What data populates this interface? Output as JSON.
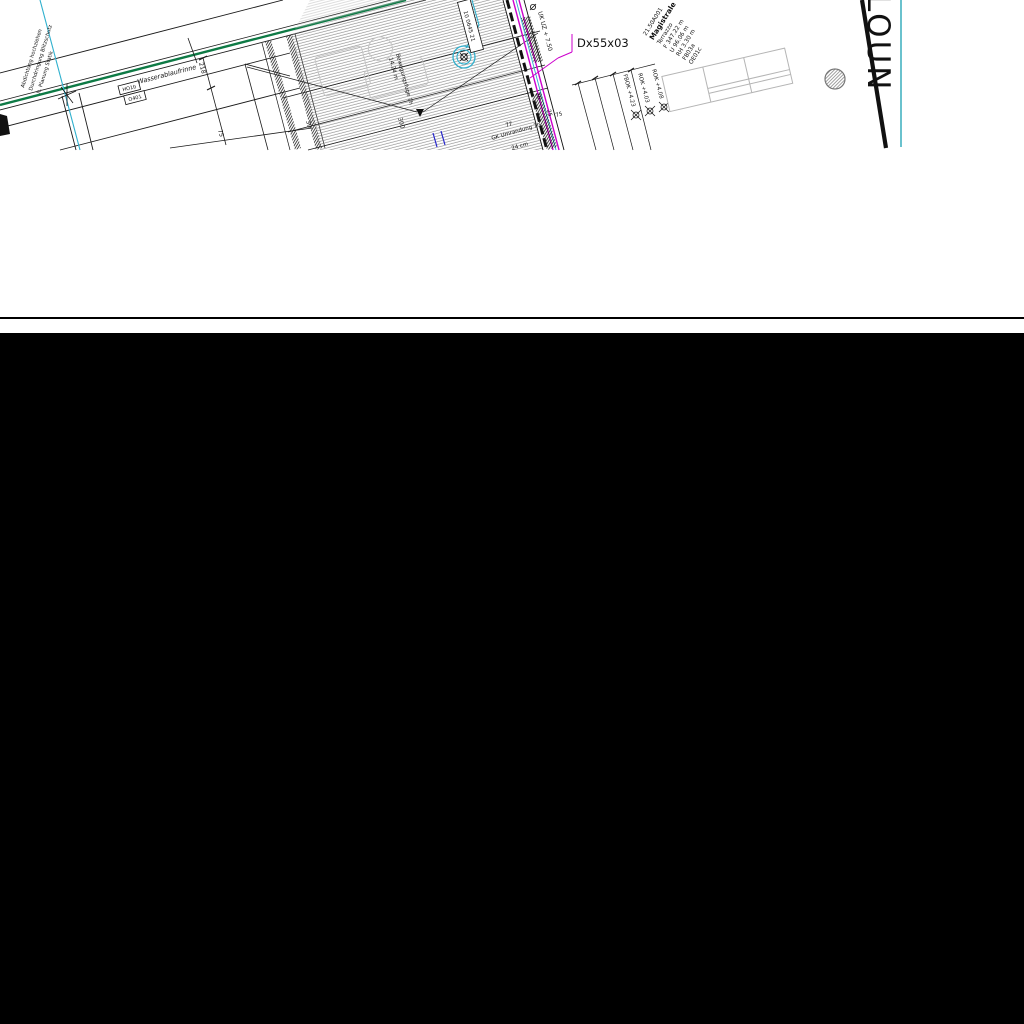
{
  "drawing": {
    "green_note": {
      "lines": [
        "Abdichtung hochziehen",
        "Durchdringung Blitzschutz",
        "lt. Planung Statik"
      ],
      "color": "#00A05A"
    },
    "channel_label": "Wasserablaufrinne",
    "ref_boxes": {
      "top": "HO1b",
      "bottom": "O401"
    },
    "dims": {
      "w218": "218",
      "w75l": "75",
      "w30": "30",
      "w300": "300",
      "w20": "20",
      "w25": "25",
      "w77": "77",
      "w75r": "75"
    },
    "joint_note": {
      "line1": "Bewegungsfuge 7h",
      "line2": "14.24 m"
    },
    "detail_tag": "10 0645 21",
    "uk_level": "UK UZ + 7.50",
    "duct_tag": {
      "text": "Dx55x03",
      "color": "#CC00CC"
    },
    "glass_note": {
      "line1": "GK Umrandung 7h",
      "line2": "24 cm"
    },
    "levels": {
      "l1": "FBOK +4.23",
      "l2": "ROK +4.03",
      "l3": "ROK +4.08"
    },
    "room_stamp": {
      "lines": [
        "21.50A001",
        "Magistrale",
        "Terrazzo",
        "F 347.22 m",
        "U 96.06 m",
        "RH 3.30 m",
        "FB03a",
        "OE01c"
      ]
    },
    "area_text": "LOUN",
    "colors": {
      "wall_green": "#0E7A45",
      "axis_cyan": "#2FB0CE",
      "facade_magenta": "#CC00CC",
      "teal_line": "#2AA9B8",
      "area_gray": "#9B9B9B"
    }
  }
}
